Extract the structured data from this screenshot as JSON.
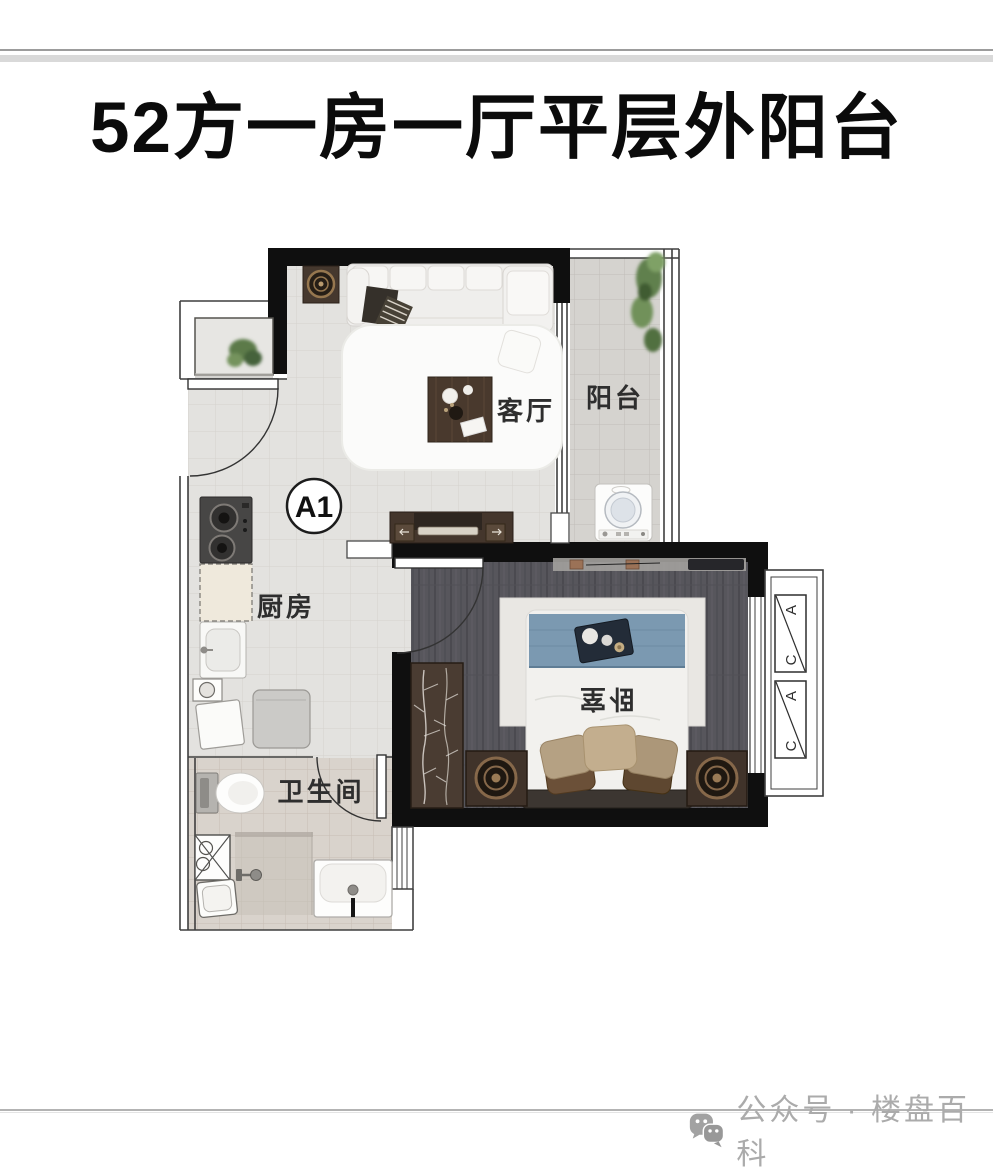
{
  "title": "52方一房一厅平层外阳台",
  "plan": {
    "unit": "A1",
    "rooms": {
      "living": "客厅",
      "balcony": "阳台",
      "kitchen": "厨房",
      "bedroom": "卧室",
      "bathroom": "卫生间"
    },
    "ac": {
      "a": "A",
      "c": "C"
    }
  },
  "footer": {
    "label": "公众号 · 楼盘百科"
  },
  "colors": {
    "wall": "#0f0f0f",
    "floor_light": "#e3e2df",
    "floor_balcony": "#d5d3cf",
    "floor_bath": "#d9d3cc",
    "floor_bedroom": "#57565c",
    "bed_blue": "#7b99b1",
    "footer_text": "#ababab"
  }
}
